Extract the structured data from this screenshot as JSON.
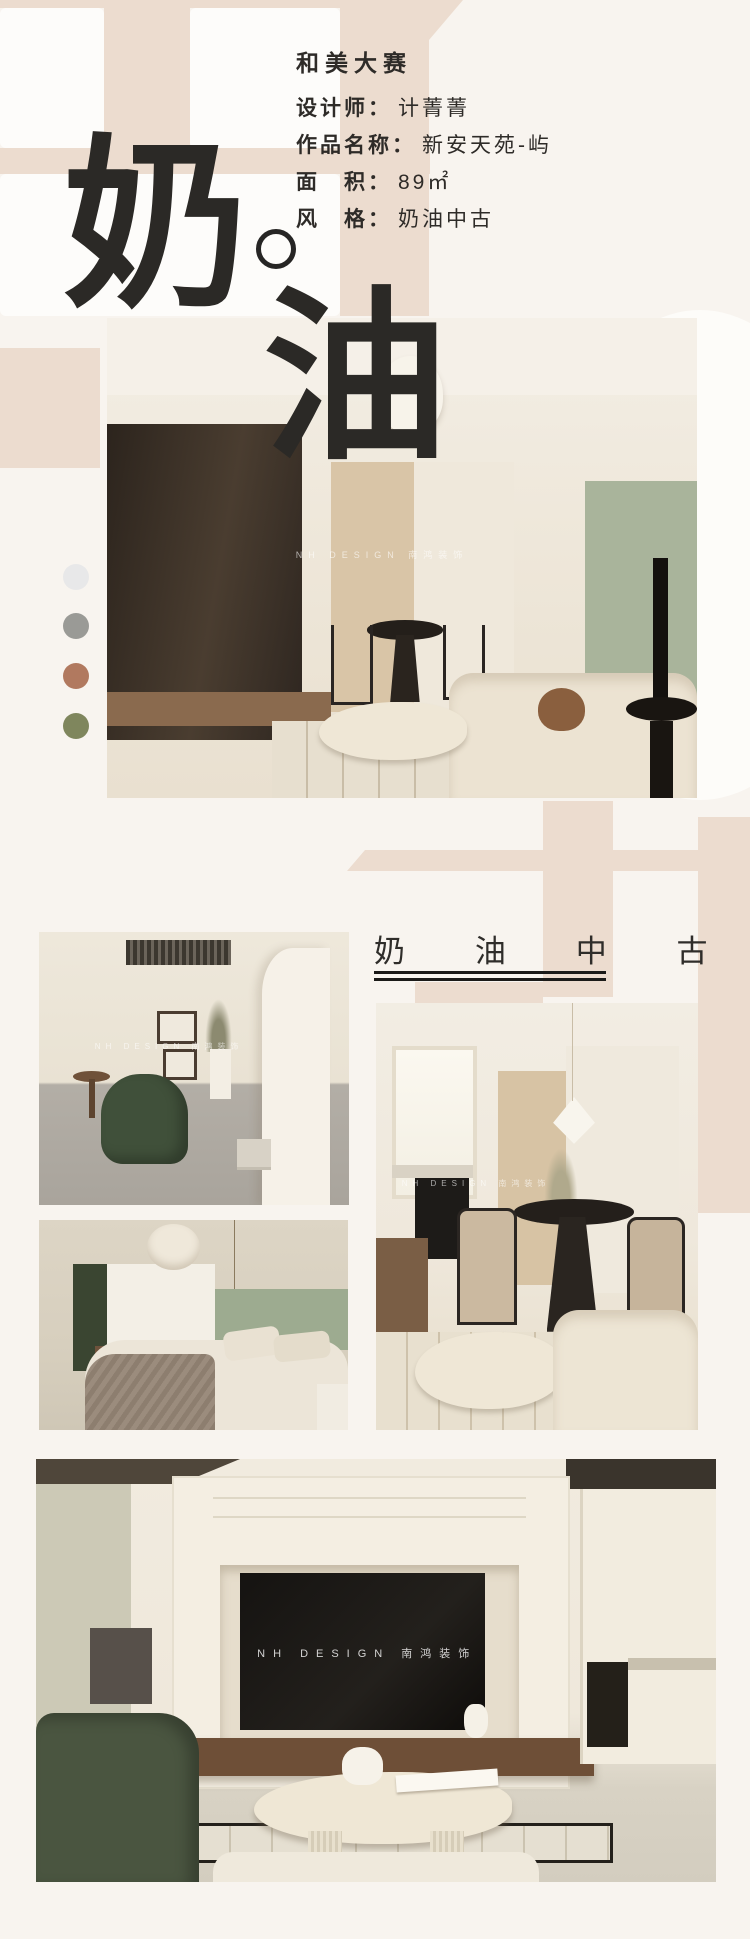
{
  "hero": {
    "char_top": "奶",
    "mark": "。",
    "char_bottom": "油"
  },
  "info": {
    "competition": "和美大赛",
    "rows": [
      {
        "label": "设计师：",
        "value": "计菁菁"
      },
      {
        "label": "作品名称：",
        "value": "新安天苑-屿"
      },
      {
        "label": "面　积：",
        "value": "89㎡"
      },
      {
        "label": "风　格：",
        "value": "奶油中古"
      }
    ]
  },
  "section_heading": {
    "text": "奶 油 中 古"
  },
  "watermark": {
    "text": "NH DESIGN 南鸿装饰"
  },
  "palette": [
    {
      "name": "light-gray-swatch",
      "color": "#e8e8e9"
    },
    {
      "name": "warm-gray-swatch",
      "color": "#9a9a96"
    },
    {
      "name": "terracotta-swatch",
      "color": "#b1795f"
    },
    {
      "name": "olive-green-swatch",
      "color": "#7f865d"
    }
  ],
  "photos": [
    {
      "id": "living-room-wide"
    },
    {
      "id": "hallway-green-chair"
    },
    {
      "id": "bedroom"
    },
    {
      "id": "dining-area"
    },
    {
      "id": "tv-wall"
    }
  ],
  "accent": {
    "beige": "#ecdccf",
    "ink": "#2b2926",
    "page_bg": "#f8f4ef"
  }
}
